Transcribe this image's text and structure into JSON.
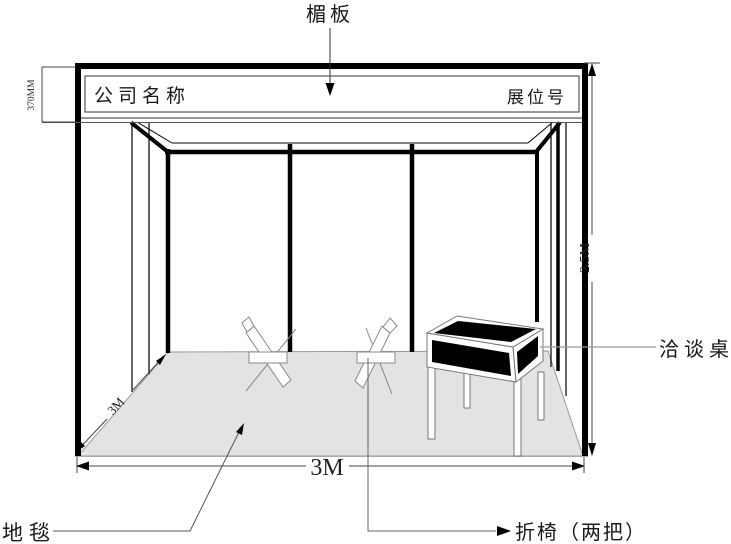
{
  "booth_diagram": {
    "labels": {
      "fascia": "楣板",
      "carpet": "地毯",
      "table": "洽谈桌",
      "chairs": "折椅（两把）"
    },
    "fascia_board": {
      "company_name": "公司名称",
      "booth_number": "展位号"
    },
    "dimensions": {
      "fascia_height": "370MM",
      "wall_height": "2.5M",
      "width": "3M",
      "depth": "3M"
    },
    "colors": {
      "line": "#000000",
      "outline_gray": "#888888",
      "carpet_fill": "#e3e3e3",
      "table_panel_fill": "#000000"
    }
  }
}
